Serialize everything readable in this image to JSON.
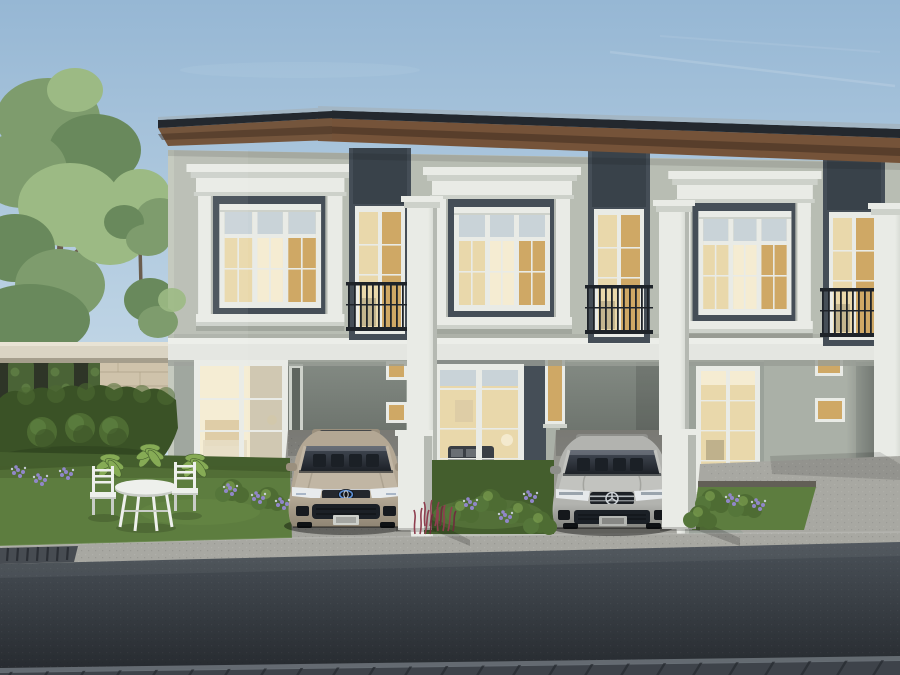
{
  "scene": {
    "description": "Photorealistic architectural rendering of a row of modern two-storey townhouses at dusk with warm interior lighting, decorative white window cornices, Juliet balconies, a champagne sedan and a silver sedan parked in the driveways, front gardens with white patio furniture, hedges and trees on the left, and an asphalt street with paver sidewalk in the foreground",
    "objects": [
      "sky",
      "large-tree",
      "small-tree",
      "garden-pergola-wall",
      "stone-wall",
      "hedge",
      "townhouse-row",
      "decorative-windows",
      "juliet-balconies",
      "pilasters",
      "gate-pillars",
      "champagne-sedan",
      "silver-sedan",
      "patio-table",
      "patio-chairs",
      "lawns",
      "flower-beds",
      "driveways",
      "road",
      "paver-sidewalk",
      "drain-grate"
    ]
  },
  "colors": {
    "sky_top": "#96b7d4",
    "sky_mid": "#bad1e3",
    "sky_low": "#d7e4ed",
    "cloud": "#eaf0f6",
    "roof_edge": "#a3b6c4",
    "roof_fascia": "#23282e",
    "soffit_light": "#755339",
    "soffit_dark": "#3f2d20",
    "wall_upper": "#b8bdb3",
    "wall_shade": "#a3a99f",
    "panel": "#454e57",
    "panel_dark": "#39424a",
    "trim": "#e9ebe6",
    "trim_shade": "#cdd1ca",
    "trim_dark": "#b5b9b2",
    "band": "#e4e6e1",
    "band_shadow": "#989e96",
    "glass_cool": "#c9d3d8",
    "glass_warm": "#e9d8ab",
    "glass_bright": "#f5ecd2",
    "glass_amber": "#cfa865",
    "interior_dark": "#3a3f45",
    "iron": "#1e2329",
    "wall_ground": "#9ba29a",
    "wall_ground_light": "#aab0a7",
    "wall_ground_dark": "#747b74",
    "recess": "#5e645e",
    "stone": "#cfc3ab",
    "stone_line": "#ab9f85",
    "beam": "#dad4c3",
    "beam_shade": "#a59e8c",
    "grass": "#5d7d3f",
    "grass_dark": "#445e2d",
    "leaf": "#86ab55",
    "hedge": "#3a5226",
    "hedge_light": "#4e6c33",
    "foliage": "#7e9c6d",
    "foliage_dark": "#69895c",
    "foliage_light": "#9cba84",
    "trunk": "#6b5d4e",
    "flower_purple": "#9187c9",
    "flower_white": "#d9ddf0",
    "flower_red": "#8f3e4f",
    "concrete": "#a8a8a2",
    "concrete_dark": "#8b8b85",
    "asphalt_top": "#4a5158",
    "asphalt_low": "#262a2f",
    "paver": "#3e434a",
    "paver_joint": "#282c32",
    "paver_edge": "#6f757d",
    "drain": "#474c52",
    "drain_slot": "#2b2f35",
    "car1": "#b3a794",
    "car1_light": "#c1b6a4",
    "car1_dark": "#9a8f7d",
    "car2": "#b2b3af",
    "car2_light": "#c2c3bf",
    "car2_dark": "#8e8f8b",
    "car_glass": "#333944",
    "car_glass_dark": "#1b2026",
    "chrome": "#ced3d7",
    "brand_blue": "#5c8fd6",
    "furniture": "#eef0ec",
    "furniture_shade": "#c9cdc7"
  }
}
